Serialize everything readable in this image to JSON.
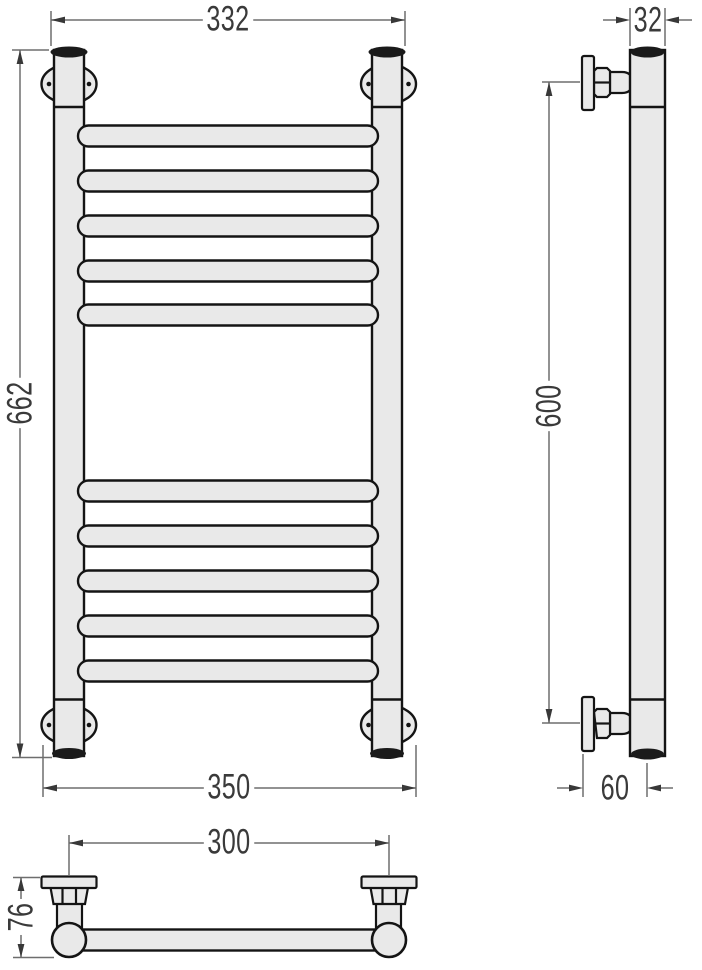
{
  "dimensions": {
    "front_top_width": "332",
    "front_height": "662",
    "front_bottom_width": "350",
    "side_tube_width": "32",
    "side_mount_height": "600",
    "side_wall_offset": "60",
    "plan_bracket_spacing": "300",
    "plan_depth": "76"
  },
  "colors": {
    "body_fill": "#e9e9e9",
    "outline": "#141414",
    "end_cap": "#1a1a1a",
    "dimension_line": "#6e6e6e",
    "arrow": "#383838",
    "text": "#3a3a3a",
    "background": "#ffffff"
  }
}
